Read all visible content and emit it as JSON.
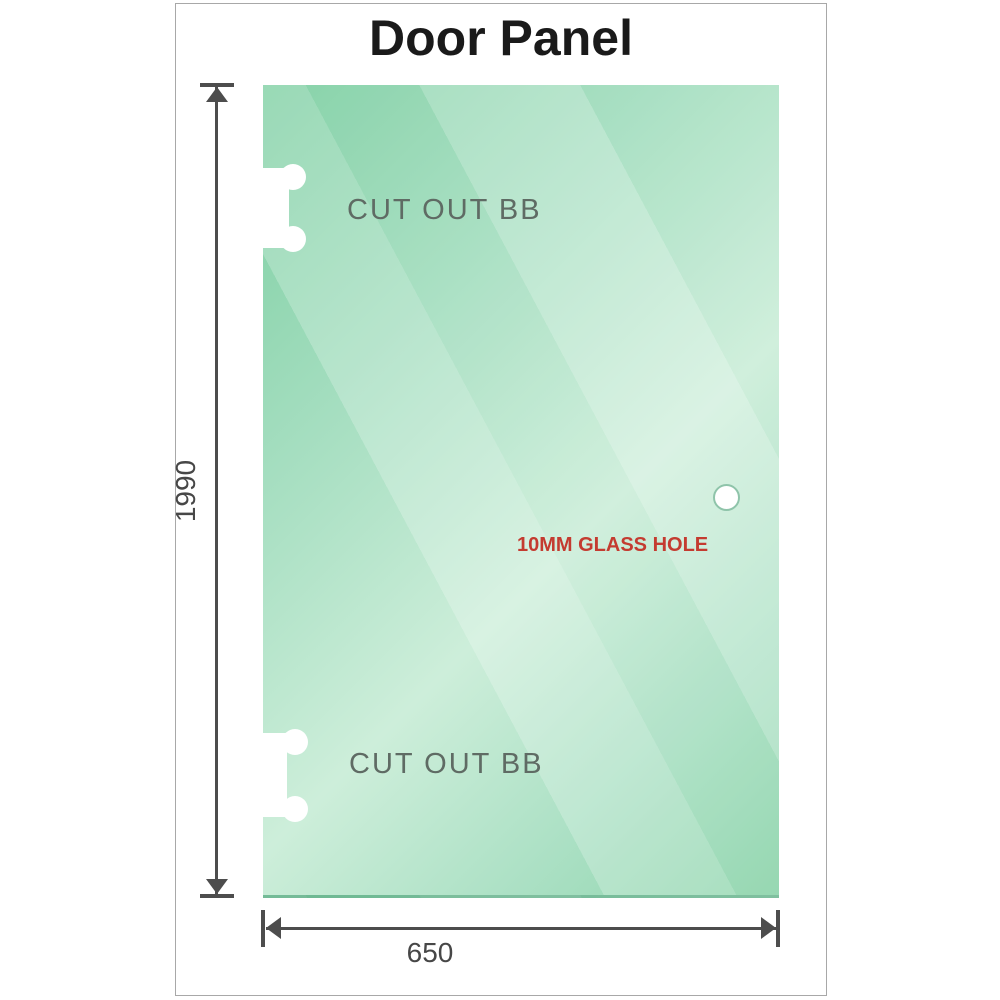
{
  "title": "Door Panel",
  "panel": {
    "cutouts": [
      {
        "label": "CUT OUT BB"
      },
      {
        "label": "CUT OUT BB"
      }
    ],
    "glass_hole": {
      "label": "10MM GLASS HOLE"
    }
  },
  "dimensions": {
    "height": {
      "value": "1990"
    },
    "width": {
      "value": "650"
    }
  },
  "colors": {
    "glass_dark": "#7ccea1",
    "glass_light": "#cdeeda",
    "glass_mid": "#8dd4ab",
    "dimension_line": "#4d4d4d",
    "cutout_text": "#5f6b64",
    "hole_text": "#c43b30",
    "title_text": "#1a1a1a",
    "frame_border": "#a8a8a8"
  }
}
